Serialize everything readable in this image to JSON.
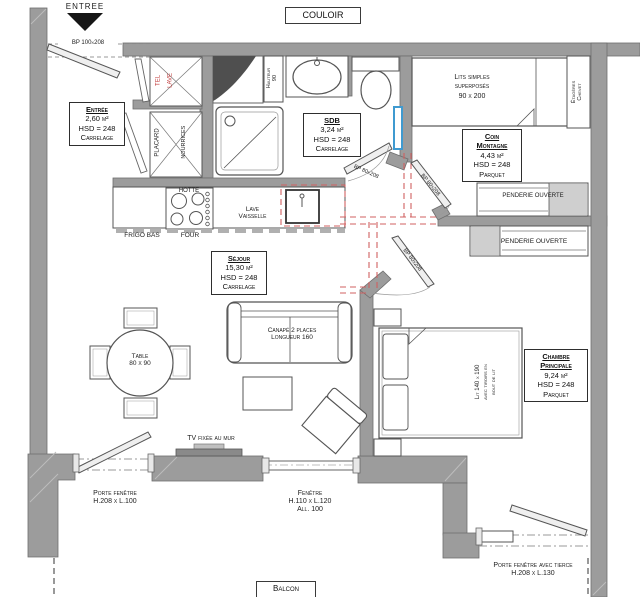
{
  "plan": {
    "entree_arrow_label": "ENTREE",
    "couloir_label": "COULOIR",
    "balcon_label": "Balcon"
  },
  "rooms": {
    "entree": {
      "name": "Entrée",
      "area": "2,60 m²",
      "height": "HSD = 248",
      "floor": "Carrelage"
    },
    "sdb": {
      "name": "SDB",
      "area": "3,24 m²",
      "height": "HSD = 248",
      "floor": "Carrelage"
    },
    "sejour": {
      "name": "Séjour",
      "area": "15,30 m²",
      "height": "HSD = 248",
      "floor": "Carrelage"
    },
    "coin_montagne": {
      "name": "Coin",
      "name2": "Montagne",
      "area": "4,43 m²",
      "height": "HSD = 248",
      "floor": "Parquet"
    },
    "chambre": {
      "name": "Chambre",
      "name2": "Principale",
      "area": "9,24 m²",
      "height": "HSD = 248",
      "floor": "Parquet"
    }
  },
  "doors": {
    "entrance_label": "BP 100x208",
    "sdb_label": "BP 80x208",
    "coin_label": "BP 80x208",
    "chambre_label": "BP 80x208"
  },
  "openings": {
    "porte_fenetre": {
      "name": "Porte fenêtre",
      "size": "H.208 x L.100"
    },
    "fenetre": {
      "name": "Fenêtre",
      "size": "H.110 x L.120",
      "sill": "All. 100"
    },
    "porte_fenetre_tierce": {
      "name": "Porte fenêtre avec tierce",
      "size": "H.208 x L.130"
    }
  },
  "storage": {
    "tel": "TEL",
    "lave": "LAVE",
    "placard": "PLACARD",
    "nourrices": "NOURRICES",
    "penderie_coin": "PENDERIE OUVERTE",
    "penderie_chambre": "PENDERIE OUVERTE",
    "etageres": "Étagères",
    "chevet": "Chevet"
  },
  "bathroom": {
    "hauteur": "Hauteur",
    "hauteur_value": "90"
  },
  "kitchen": {
    "hotte": "HOTTE",
    "lave_vaisselle_1": "Lave",
    "lave_vaisselle_2": "Vaisselle",
    "frigo": "FRIGO BAS",
    "four": "FOUR"
  },
  "furniture": {
    "canape_1": "Canapé 2 places",
    "canape_2": "Longueur 160",
    "table_1": "Table",
    "table_2": "80 x 90",
    "tv": "TV fixée au mur",
    "lits_superposes_1": "Lits simples",
    "lits_superposes_2": "superposés",
    "lits_superposes_3": "90 x 200",
    "lit_double_1": "Lit 140 x 190",
    "lit_double_2": "avec tiroirs en",
    "lit_double_3": "bout de lit"
  },
  "colors": {
    "wall": "#9c9c9c",
    "line": "#555555",
    "red_dash": "#d06060",
    "radiator_blue": "#3f9ad0"
  }
}
